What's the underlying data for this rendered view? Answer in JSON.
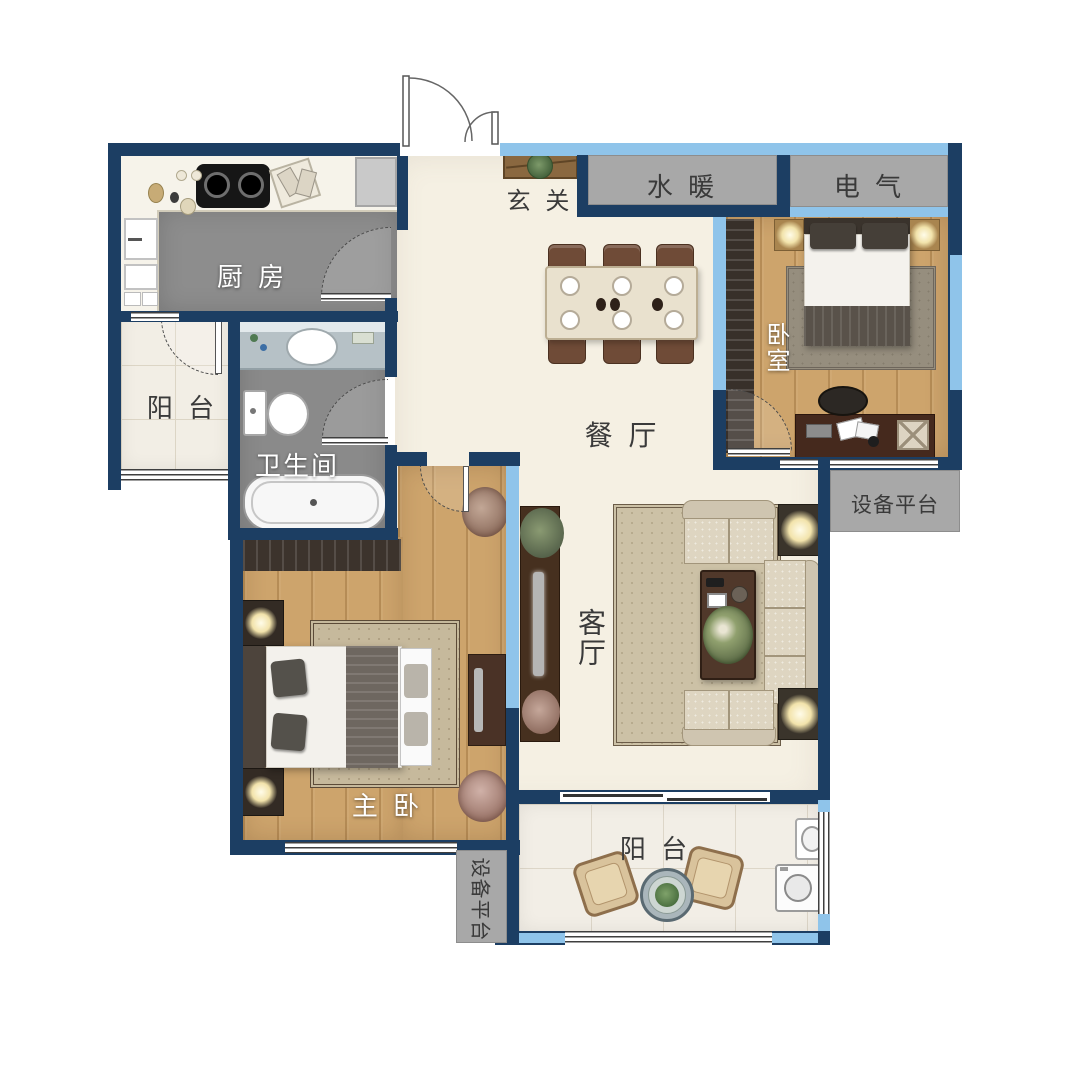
{
  "title": "apartment-floor-plan",
  "palette": {
    "wall_navy": "#1c3e63",
    "window_blue": "#8fc4ea",
    "partition_gray": "#a8a8a8",
    "floor_cream": "#f5f0e3",
    "floor_gray": "#8d8d8d",
    "floor_wood": "#cda46c",
    "floor_tile": "#f2eee5",
    "label_dark": "#3a3a3a",
    "label_white": "#ffffff"
  },
  "labels": {
    "kitchen": "厨 房",
    "balcony_left": "阳 台",
    "bathroom": "卫生间",
    "entry": "玄 关",
    "plumbing": "水 暖",
    "electrical": "电 气",
    "bedroom": "卧室",
    "dining": "餐 厅",
    "living": "客厅",
    "master": "主 卧",
    "equipment_right": "设备平台",
    "equipment_left": "设备平台",
    "balcony_bottom": "阳 台"
  }
}
